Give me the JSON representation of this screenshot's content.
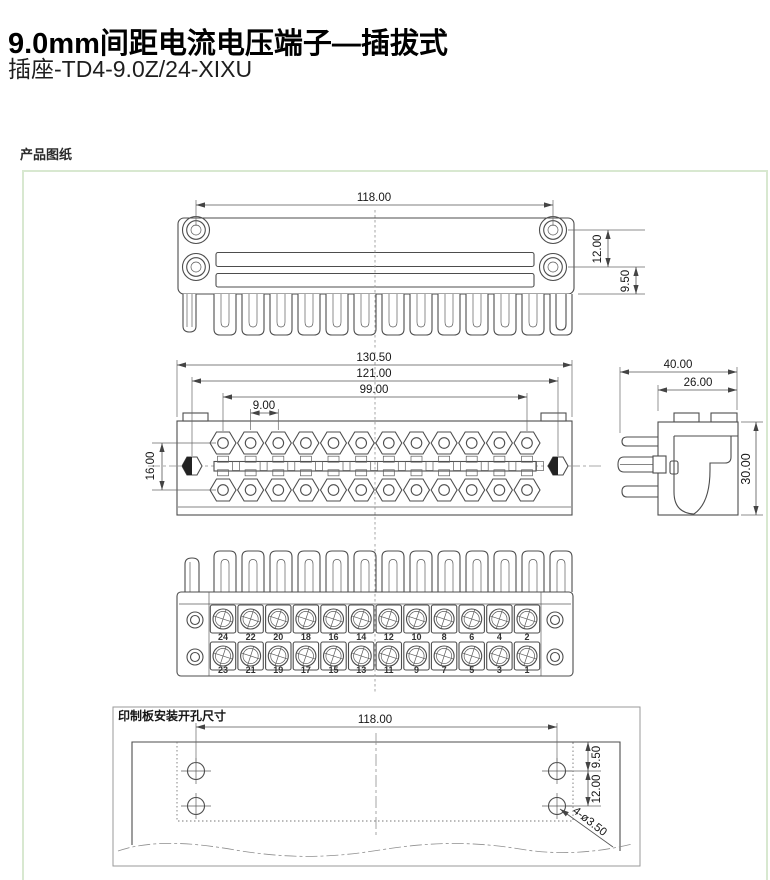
{
  "header": {
    "title": "9.0mm间距电流电压端子—插拔式",
    "model": "插座-TD4-9.0Z/24-XIXU"
  },
  "section_label": "产品图纸",
  "colors": {
    "panel_border": "#d8e8d0",
    "drawing_line": "#4d4d4d",
    "text": "#161616"
  },
  "drawing": {
    "top_view": {
      "overall_width": "118.00",
      "hole_spacing_v": "12.00",
      "hole_to_edge": "9.50"
    },
    "front_view": {
      "overall_width": "130.50",
      "flange_span": "121.00",
      "terminal_span": "99.00",
      "pitch": "9.00",
      "row_spacing": "16.00"
    },
    "side_view": {
      "overall_depth": "40.00",
      "body_depth": "26.00",
      "height": "30.00"
    },
    "rear_view": {
      "top_row_numbers": [
        "24",
        "22",
        "20",
        "18",
        "16",
        "14",
        "12",
        "10",
        "8",
        "6",
        "4",
        "2"
      ],
      "bottom_row_numbers": [
        "23",
        "21",
        "19",
        "17",
        "15",
        "13",
        "11",
        "9",
        "7",
        "5",
        "3",
        "1"
      ]
    },
    "pcb_view": {
      "label": "印制板安装开孔尺寸",
      "hole_span": "118.00",
      "hole_to_edge": "9.50",
      "hole_spacing_v": "12.00",
      "hole_callout": "4-ø3.50"
    }
  }
}
